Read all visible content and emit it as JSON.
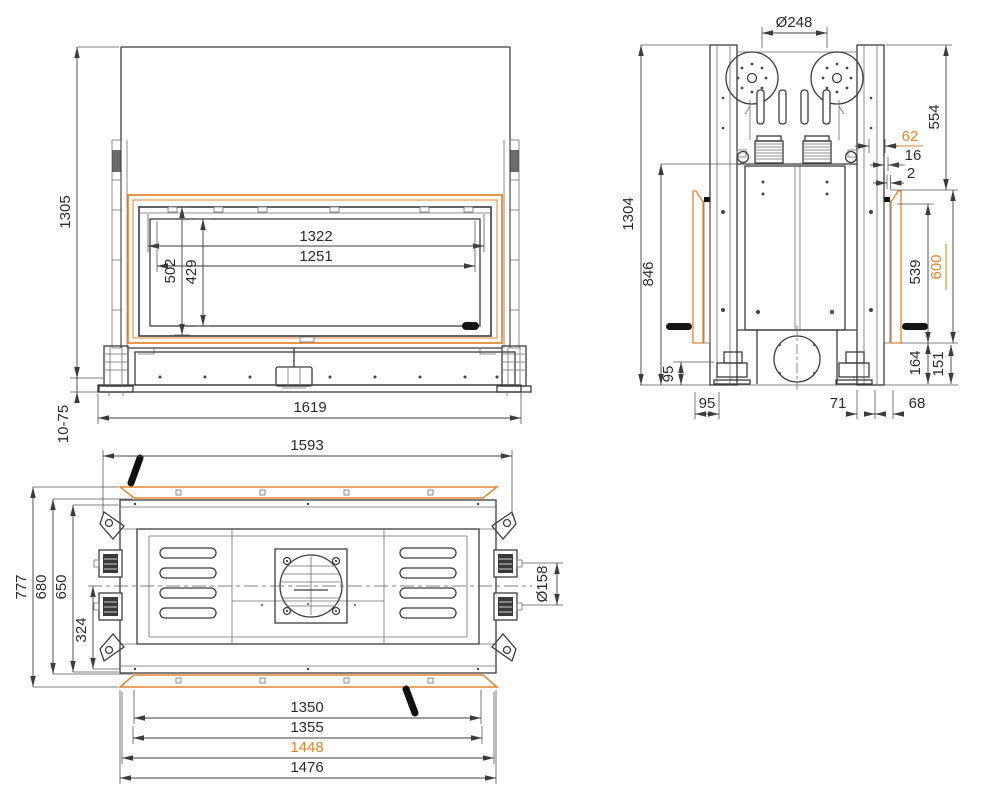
{
  "colors": {
    "line": "#3c3c3c",
    "accent": "#e5832d"
  },
  "views": {
    "front": {
      "name": "front-elevation",
      "dims": {
        "overall_height": "1305",
        "leveling_range": "10-75",
        "glass_opening_width": "1322",
        "glass_visible_width": "1251",
        "glass_opening_height": "502",
        "glass_visible_height": "429",
        "base_width": "1619"
      }
    },
    "side": {
      "name": "side-elevation",
      "dims": {
        "pulley_diameter": "Ø248",
        "upper_section_height": "554",
        "trim_depth": "62",
        "offset_16": "16",
        "offset_2": "2",
        "overall_height": "1304",
        "body_height": "846",
        "opening_height": "539",
        "trim_height": "600",
        "rear_foot_offset": "95",
        "height_164": "164",
        "height_151": "151",
        "base_offset_95": "95",
        "base_offset_71": "71",
        "base_offset_68": "68"
      }
    },
    "top": {
      "name": "top-plan",
      "dims": {
        "overall_width": "1593",
        "overall_depth": "777",
        "inner_depth_680": "680",
        "body_depth_650": "650",
        "half_depth_324": "324",
        "flue_diameter": "Ø158",
        "width_1350": "1350",
        "width_1355": "1355",
        "width_1448": "1448",
        "width_1476": "1476"
      }
    }
  }
}
